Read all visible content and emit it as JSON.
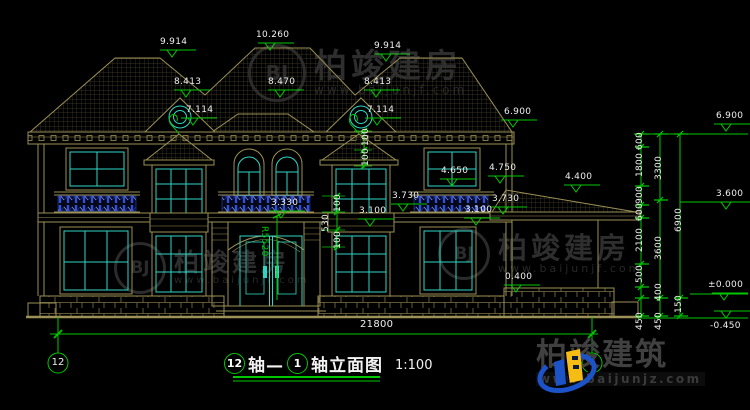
{
  "drawing_title": {
    "axis_left": "12",
    "axis_sep": "轴—",
    "axis_right": "1",
    "suffix": "轴立面图",
    "scale": "1:100"
  },
  "axis_markers": {
    "left": "12",
    "right": "1"
  },
  "watermark": {
    "brand": "柏竣建房",
    "url": "www.baijunjf.com",
    "monogram": "BJ"
  },
  "logo": {
    "brand": "柏竣建筑",
    "url": "www.baijunjz.com"
  },
  "colors": {
    "background": "#000000",
    "wall_line": "#9c9156",
    "window_line": "#2fd6c4",
    "railing": "#3050dd",
    "dimension_green": "#00c800",
    "text_white": "#efefef",
    "watermark_gray": "#2e2e2e",
    "logo_blue": "#1c53c9",
    "logo_yellow": "#f5bc16"
  },
  "dim_labels": [
    {
      "t": "9.914",
      "x": 160,
      "y": 38
    },
    {
      "t": "10.260",
      "x": 256,
      "y": 31
    },
    {
      "t": "9.914",
      "x": 374,
      "y": 42
    },
    {
      "t": "8.413",
      "x": 174,
      "y": 78
    },
    {
      "t": "8.470",
      "x": 268,
      "y": 78
    },
    {
      "t": "8.413",
      "x": 364,
      "y": 78
    },
    {
      "t": "7.114",
      "x": 186,
      "y": 106
    },
    {
      "t": "7.114",
      "x": 367,
      "y": 106
    },
    {
      "t": "6.900",
      "x": 504,
      "y": 108
    },
    {
      "t": "4.650",
      "x": 441,
      "y": 167
    },
    {
      "t": "4.750",
      "x": 489,
      "y": 164
    },
    {
      "t": "3.730",
      "x": 392,
      "y": 192
    },
    {
      "t": "3.730",
      "x": 492,
      "y": 195
    },
    {
      "t": "3.100",
      "x": 359,
      "y": 207
    },
    {
      "t": "3.100",
      "x": 465,
      "y": 206
    },
    {
      "t": "4.400",
      "x": 565,
      "y": 173
    },
    {
      "t": "0.400",
      "x": 505,
      "y": 273
    },
    {
      "t": "3.330",
      "x": 271,
      "y": 199
    },
    {
      "t": "21800",
      "x": 360,
      "y": 320,
      "s": 10
    },
    {
      "t": "R5520",
      "x": 268,
      "y": 226,
      "r": 90,
      "c": "#00c800"
    },
    {
      "t": "100",
      "x": 334,
      "y": 212,
      "r": -90
    },
    {
      "t": "530",
      "x": 322,
      "y": 232,
      "r": -90
    },
    {
      "t": "100",
      "x": 334,
      "y": 249,
      "r": -90
    },
    {
      "t": "100",
      "x": 362,
      "y": 146,
      "r": -90
    },
    {
      "t": "100",
      "x": 362,
      "y": 166,
      "r": -90
    },
    {
      "t": "600",
      "x": 636,
      "y": 150,
      "r": -90
    },
    {
      "t": "1800",
      "x": 636,
      "y": 177,
      "r": -90
    },
    {
      "t": "900",
      "x": 636,
      "y": 204,
      "r": -90
    },
    {
      "t": "600",
      "x": 636,
      "y": 221,
      "r": -90
    },
    {
      "t": "2100",
      "x": 636,
      "y": 252,
      "r": -90
    },
    {
      "t": "500",
      "x": 636,
      "y": 283,
      "r": -90
    },
    {
      "t": "450",
      "x": 636,
      "y": 330,
      "r": -90
    },
    {
      "t": "3300",
      "x": 655,
      "y": 180,
      "r": -90
    },
    {
      "t": "3600",
      "x": 655,
      "y": 260,
      "r": -90
    },
    {
      "t": "400",
      "x": 655,
      "y": 301,
      "r": -90
    },
    {
      "t": "450",
      "x": 655,
      "y": 330,
      "r": -90
    },
    {
      "t": "6900",
      "x": 675,
      "y": 232,
      "r": -90
    },
    {
      "t": "150",
      "x": 675,
      "y": 313,
      "r": -90
    },
    {
      "t": "6.900",
      "x": 716,
      "y": 112
    },
    {
      "t": "3.600",
      "x": 716,
      "y": 190
    },
    {
      "t": "±0.000",
      "x": 708,
      "y": 281
    },
    {
      "t": "-0.450",
      "x": 710,
      "y": 322
    }
  ]
}
